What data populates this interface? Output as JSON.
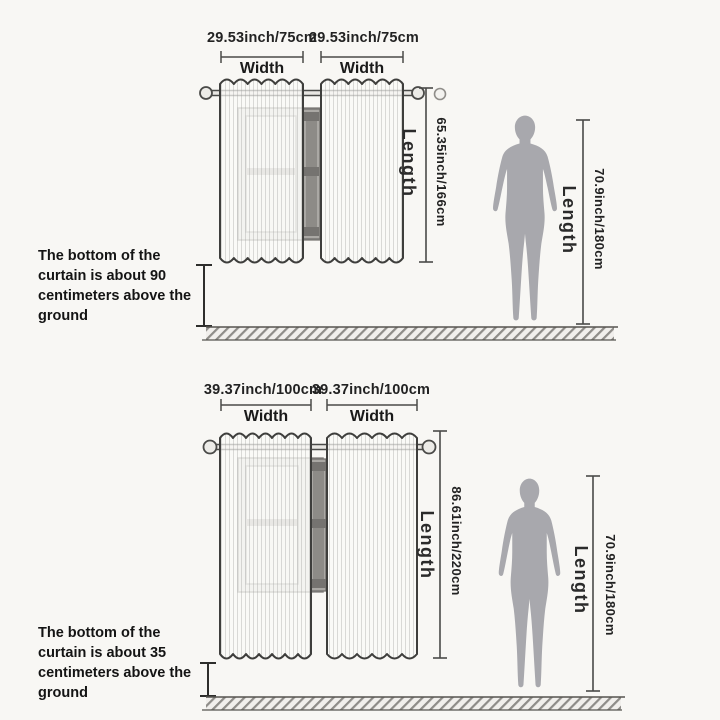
{
  "colors": {
    "background": "#f8f7f4",
    "line": "#4a4a48",
    "silhouette": "#a8a8ad",
    "text": "#1b1b1b"
  },
  "sections": [
    {
      "panels": [
        {
          "dimension": "29.53inch/75cm",
          "axis": "Width"
        },
        {
          "dimension": "29.53inch/75cm",
          "axis": "Width"
        }
      ],
      "curtain_length": {
        "label": "Length",
        "value": "65.35inch/166cm"
      },
      "person_height": {
        "label": "Length",
        "value": "70.9inch/180cm"
      },
      "note_lines": [
        "The bottom of the",
        "curtain is about 90",
        "centimeters above the",
        "ground"
      ]
    },
    {
      "panels": [
        {
          "dimension": "39.37inch/100cm",
          "axis": "Width"
        },
        {
          "dimension": "39.37inch/100cm",
          "axis": "Width"
        }
      ],
      "curtain_length": {
        "label": "Length",
        "value": "86.61inch/220cm"
      },
      "person_height": {
        "label": "Length",
        "value": "70.9inch/180cm"
      },
      "note_lines": [
        "The bottom of the",
        "curtain is about 35",
        "centimeters above the",
        "ground"
      ]
    }
  ]
}
